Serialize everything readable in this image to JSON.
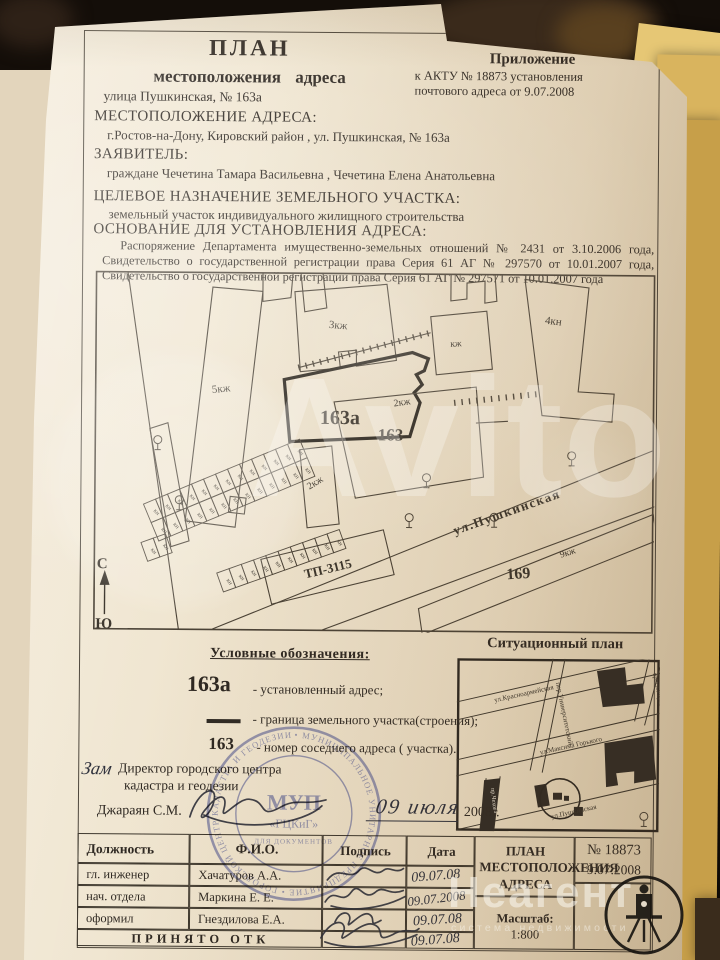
{
  "watermarks": {
    "avito": "Avito",
    "neagent": "Неагент",
    "neagent_sub": "система недвижимости"
  },
  "header": {
    "plan_title": "ПЛАН",
    "plan_subtitle": "местоположения   адреса",
    "appendix_title": "Приложение",
    "appendix_line1": "к   АКТУ    № 18873   установления",
    "appendix_line2": "почтового адреса    от   9.07.2008",
    "street_line": "улица Пушкинская,  № 163а"
  },
  "sections": {
    "location_label": "МЕСТОПОЛОЖЕНИЕ АДРЕСА:",
    "location_value": "г.Ростов-на-Дону, Кировский район , ул. Пушкинская, № 163а",
    "applicant_label": "ЗАЯВИТЕЛЬ:",
    "applicant_value": "граждане Чечетина Тамара Васильевна , Чечетина Елена Анатольевна",
    "purpose_label": "ЦЕЛЕВОЕ НАЗНАЧЕНИЕ ЗЕМЕЛЬНОГО УЧАСТКА:",
    "purpose_value": "земельный участок индивидуального жилищного строительства",
    "basis_label": "ОСНОВАНИЕ ДЛЯ УСТАНОВЛЕНИЯ АДРЕСА:",
    "basis_value": "Распоряжение Департамента имущественно-земельных отношений № 2431 от 3.10.2006 года,  Свидетельство о государственной регистрации права Серия 61 АГ № 297570 от 10.01.2007 года,  Свидетельство о государственной регистрации права Серия 61 АГ № 297571 от 10.01.2007 года"
  },
  "plan": {
    "labels": {
      "b5": "5кж",
      "b3": "3кж",
      "b4": "4кн",
      "kzh": "кж",
      "b2": "2кж",
      "plot": "163а",
      "neighbor": "163",
      "n169": "169",
      "b9": "9кж",
      "street": "ул.Пушкинская",
      "tp": "ТП-3115",
      "kn": "кн",
      "north": "С",
      "south": "Ю"
    }
  },
  "legend": {
    "title": "Условные обозначения:",
    "mark1": "163а",
    "text1": "- установленный адрес;",
    "text2": "- граница земельного участка(строения);",
    "mark3": "163",
    "text3": "- номер соседнего адреса ( участка)."
  },
  "sitplan": {
    "title": "Ситуационный план",
    "streets": {
      "krasnoarmeyskaya": "ул.Красноармейская",
      "universitetsky": "пер.Университетский",
      "kirovsky": "просп.Кировский",
      "gorkogo": "ул.Максима Горького",
      "pushkinskaya": "ул.Пушкинская",
      "left": "пр.Чехова"
    }
  },
  "approval": {
    "prefix": "Зам",
    "line1": "Директор городского центра",
    "line2": "кадастра и геодезии",
    "name": "Джараян С.М.",
    "hand_date": "09  июля",
    "year": "2008г."
  },
  "stamp": {
    "ring": "• МУНИЦИПАЛЬНОЕ УНИТАРНОЕ ПРЕДПРИЯТИЕ • ГОРОДСКОЙ ЦЕНТР КАДАСТРА И ГЕОДЕЗИИ • г. РОСТОВ-НА-ДОНУ",
    "center": "МУП",
    "center2": "«ГЦКиГ»",
    "small": "ДЛЯ ДОКУМЕНТОВ"
  },
  "table": {
    "headers": {
      "role": "Должность",
      "name": "Ф.И.О.",
      "sign": "Подпись",
      "date": "Дата"
    },
    "rows": [
      {
        "role": "гл. инженер",
        "name": "Хачатуров А.А.",
        "date": "09.07.08"
      },
      {
        "role": "нач. отдела",
        "name": "Маркина Е. Е.",
        "date": "09.07.2008"
      },
      {
        "role": "оформил",
        "name": "Гнездилова Е.А.",
        "date": "09.07.08"
      }
    ],
    "accepted": "ПРИНЯТО ОТК",
    "accepted_date": "09.07.08",
    "title": "ПЛАН МЕСТОПОЛОЖЕНИЯ АДРЕСА",
    "number": "№ 18873",
    "ndate": "9.07.2008",
    "scale_label": "Масштаб:",
    "scale_value": "1:800"
  }
}
